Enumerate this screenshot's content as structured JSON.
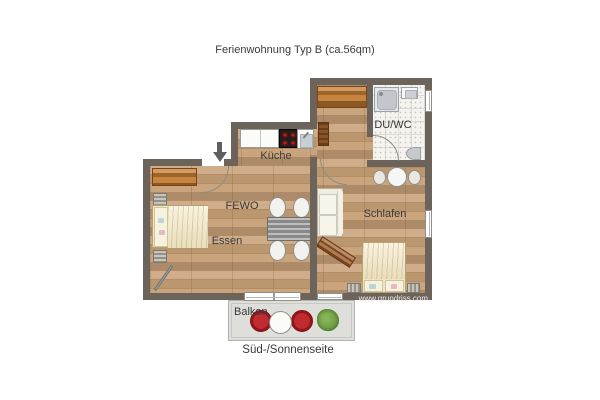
{
  "title": "Ferienwohnung Typ B (ca.56qm)",
  "caption": "Süd-/Sonnenseite",
  "watermark": "www.grundriss.com",
  "rooms": {
    "kitchen": {
      "label": "Küche"
    },
    "living": {
      "label": "FEWO"
    },
    "dining": {
      "label": "Essen"
    },
    "bedroom": {
      "label": "Schlafen"
    },
    "bathroom": {
      "label": "DU/WC"
    },
    "balcony": {
      "label": "Balkon"
    }
  },
  "colors": {
    "wall": "#6c635a",
    "wood": "#c7a077",
    "tile": "#f4f3ef",
    "balcony_floor": "#dededa",
    "furniture_orange": "#c07a30",
    "chair_red": "#bf2b2e",
    "plant_green": "#6fa047",
    "bed_cream": "#f1e5c0",
    "text": "#3a3a3a",
    "watermark_text": "#ebebe7"
  }
}
